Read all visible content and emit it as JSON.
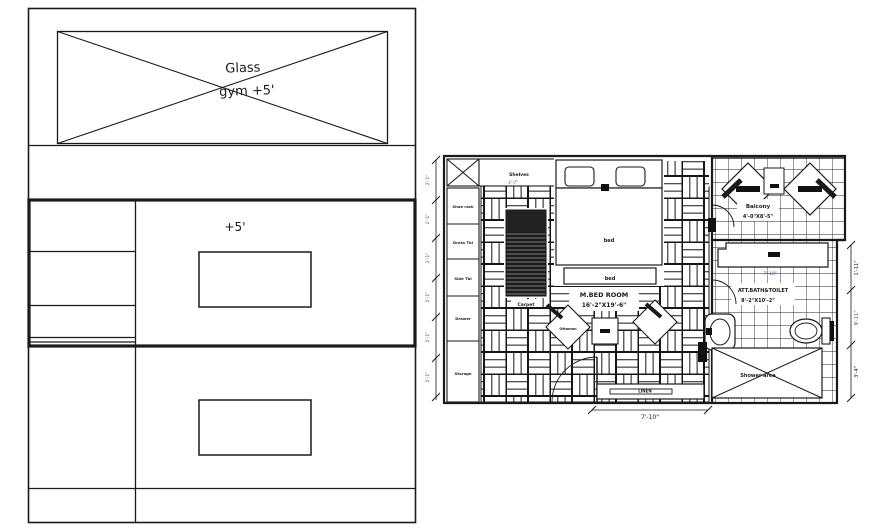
{
  "meta": {
    "bg": "#ffffff",
    "ink": "#1a1a1a",
    "dim_blue": "#4553b4"
  },
  "elevation": {
    "glass_line1": "Glass",
    "glass_line2": "gym +5'",
    "level": "+5'"
  },
  "plan": {
    "shelves": "Shelves",
    "closet_cells": [
      "Shoe rack",
      "Dress Tbl",
      "Side Tbl",
      "Drawer",
      "Storage"
    ],
    "bed": "bed",
    "bed_foot": "bed",
    "carpet": "Carpet",
    "ottoman": "Ottoman",
    "room_name": "M.BED ROOM",
    "room_size": "16'-2\"X19'-6\"",
    "balcony_name": "Balcony",
    "balcony_size": "4'-0\"X8'-5\"",
    "bath_name": "ATT.BATH&TOILET",
    "bath_size": "8'-2\"X10'-2\"",
    "shower": "Shower area",
    "linen": "LINEN",
    "dims": {
      "bottom": "7'-10\"",
      "vanity": "7'-10\"",
      "shelf": "3'-7\"",
      "right_top": "1'-11\"",
      "right_mid": "9'-11\"",
      "right_bottom": "3'-4\"",
      "left_segments": [
        "2'-1\"",
        "2'-1\"",
        "2'-1\"",
        "2'-1\"",
        "2'-1\"",
        "2'-1\""
      ]
    }
  }
}
